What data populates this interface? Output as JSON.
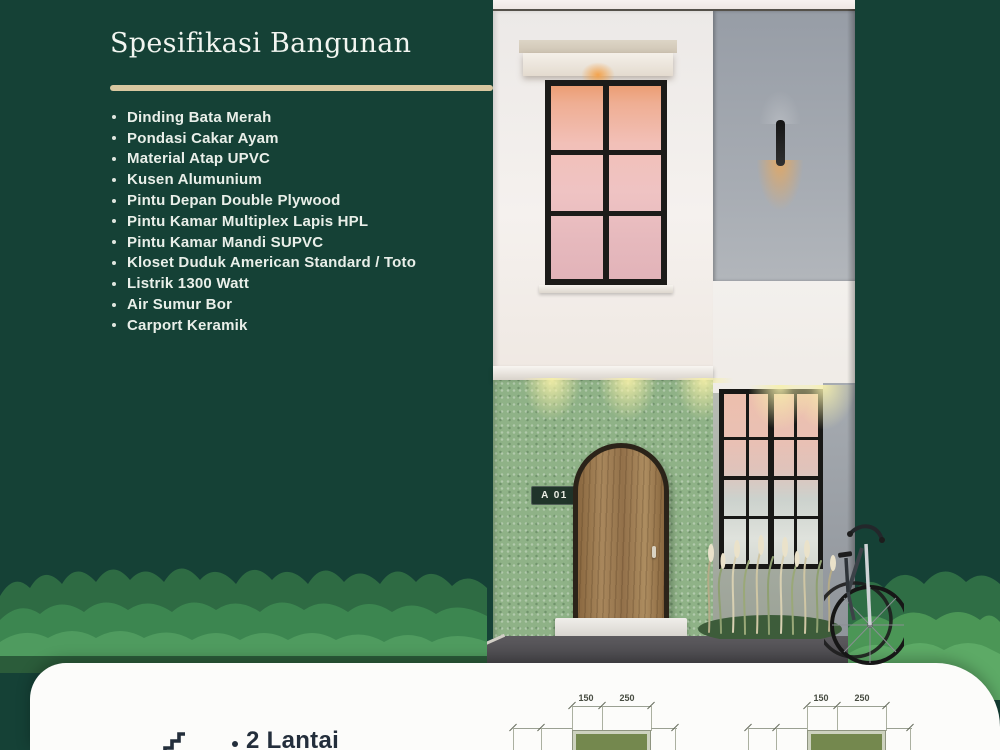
{
  "poster": {
    "background_color": "#154136",
    "accent_color": "#d8c7a0",
    "card_color": "#fcfcfa"
  },
  "header": {
    "title": "Spesifikasi Bangunan"
  },
  "specs": {
    "items": [
      "Dinding Bata Merah",
      "Pondasi Cakar Ayam",
      "Material Atap UPVC",
      "Kusen Alumunium",
      "Pintu Depan Double Plywood",
      "Pintu Kamar Multiplex Lapis HPL",
      "Pintu Kamar Mandi SUPVC",
      "Kloset Duduk American Standard / Toto",
      "Listrik 1300 Watt",
      "Air Sumur Bor",
      "Carport Keramik"
    ]
  },
  "house": {
    "unit_label": "A 01"
  },
  "footer": {
    "features": [
      {
        "label": "2 Lantai"
      }
    ],
    "floor_plans": [
      {
        "width_left": "150",
        "width_right": "250"
      },
      {
        "width_left": "150",
        "width_right": "250"
      }
    ]
  }
}
